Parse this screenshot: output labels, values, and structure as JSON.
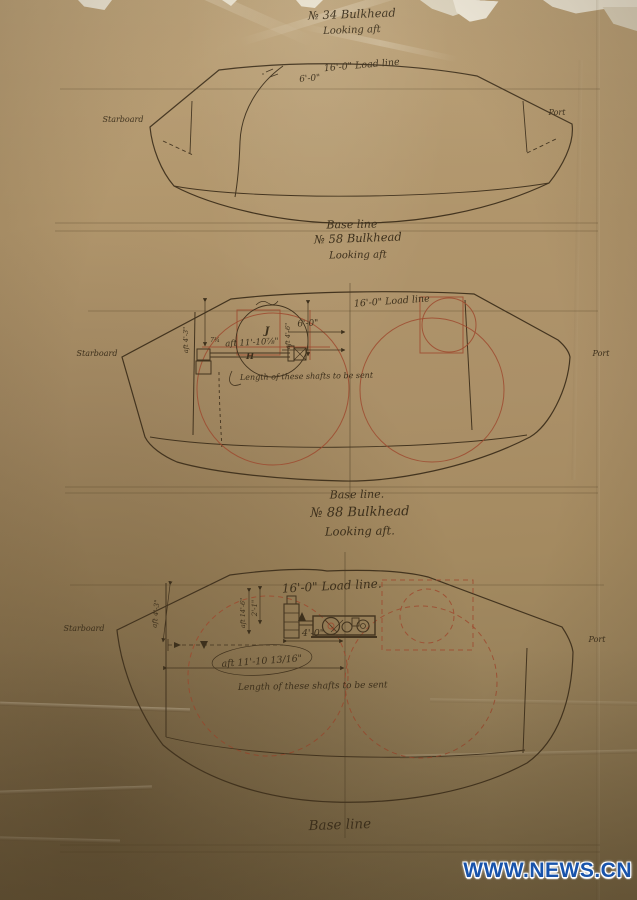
{
  "colors": {
    "paper": "#ab9068",
    "ink": "#3d301c",
    "red_ink": "#9d4a2f",
    "watermark_blue": "#1853ab"
  },
  "watermark": {
    "text": "WWW.NEWS.CN"
  },
  "drawings": [
    {
      "title": "№ 34 Bulkhead",
      "subtitle": "Looking aft",
      "load_line": "16'-0\" Load line",
      "dim_6": "6'-0\"",
      "starboard": "Starboard",
      "port": "Port",
      "base_line": "Base line"
    },
    {
      "title": "№ 58 Bulkhead",
      "subtitle": "Looking aft",
      "load_line": "16'-0\" Load line",
      "dim_6": "6'-0\"",
      "dim_shaft": "aft 11'-10⅞\"",
      "dim_left": "aft 4'-3\"",
      "dim_inner": "aft 4'-6\"",
      "dim_small": "7¾",
      "label_j": "J",
      "label_h": "H",
      "note": "Length of these shafts to be sent",
      "starboard": "Starboard",
      "port": "Port",
      "base_line": "Base line."
    },
    {
      "title": "№ 88 Bulkhead",
      "subtitle": "Looking aft.",
      "load_line": "16'-0\" Load line.",
      "dim_2_1": "2'-1\"",
      "dim_4_0": "4'-0\"",
      "dim_shaft": "aft 11'-10 13/16\"",
      "dim_left": "aft 4'-3\"",
      "dim_inner": "aft 14'-6\"",
      "note": "Length of these shafts to be sent",
      "starboard": "Starboard",
      "port": "Port",
      "base_line": "Base line"
    }
  ]
}
